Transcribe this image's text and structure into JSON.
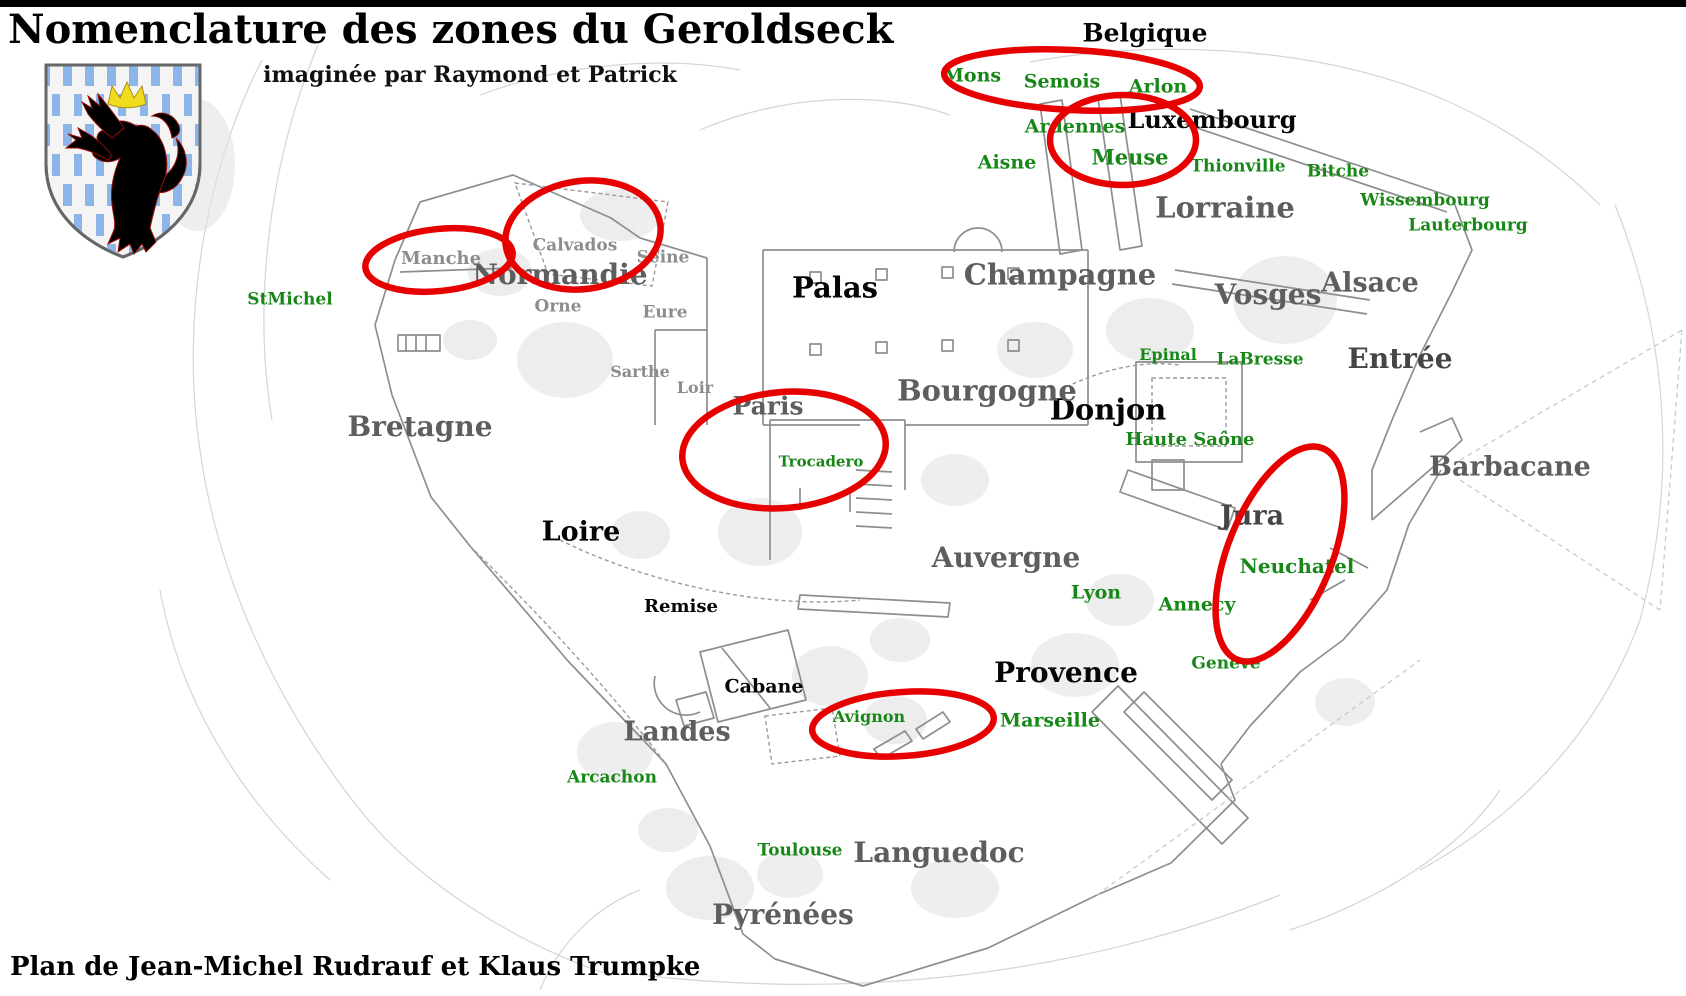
{
  "header": {
    "title": "Nomenclature des zones du Geroldseck",
    "subtitle": "imaginée par Raymond et Patrick"
  },
  "footer": {
    "credit": "Plan de Jean-Michel Rudrauf et Klaus Trumpke"
  },
  "palette": {
    "black": "#050505",
    "dark": "#454545",
    "gray": "#5e5e5e",
    "lightgray": "#8d8d8d",
    "green": "#178717",
    "annotation_red": "#e60000",
    "crest_field": "#f4f4f4",
    "crest_stripe_blue": "#8cb6ea",
    "crest_lion_red": "#e81309",
    "crest_crown_yellow": "#f2da1e"
  },
  "map": {
    "annotation_stroke_width": 6.5,
    "labels": [
      {
        "text": "Belgique",
        "x": 1145,
        "y": 33,
        "size": 25,
        "color": "black"
      },
      {
        "text": "Luxembourg",
        "x": 1212,
        "y": 120,
        "size": 24,
        "color": "black"
      },
      {
        "text": "Palas",
        "x": 835,
        "y": 288,
        "size": 29,
        "color": "black"
      },
      {
        "text": "Donjon",
        "x": 1108,
        "y": 410,
        "size": 29,
        "color": "black"
      },
      {
        "text": "Loire",
        "x": 581,
        "y": 532,
        "size": 27,
        "color": "black"
      },
      {
        "text": "Remise",
        "x": 681,
        "y": 607,
        "size": 18,
        "color": "black"
      },
      {
        "text": "Cabane",
        "x": 764,
        "y": 687,
        "size": 19,
        "color": "black"
      },
      {
        "text": "Provence",
        "x": 1066,
        "y": 673,
        "size": 28,
        "color": "black"
      },
      {
        "text": "Entrée",
        "x": 1400,
        "y": 359,
        "size": 28,
        "color": "dark"
      },
      {
        "text": "Jura",
        "x": 1252,
        "y": 516,
        "size": 27,
        "color": "dark"
      },
      {
        "text": "Normandie",
        "x": 560,
        "y": 275,
        "size": 28,
        "color": "gray"
      },
      {
        "text": "Champagne",
        "x": 1060,
        "y": 275,
        "size": 29,
        "color": "gray"
      },
      {
        "text": "Lorraine",
        "x": 1225,
        "y": 208,
        "size": 29,
        "color": "gray"
      },
      {
        "text": "Vosges",
        "x": 1268,
        "y": 295,
        "size": 28,
        "color": "gray"
      },
      {
        "text": "Alsace",
        "x": 1370,
        "y": 283,
        "size": 27,
        "color": "gray"
      },
      {
        "text": "Bourgogne",
        "x": 987,
        "y": 391,
        "size": 29,
        "color": "gray"
      },
      {
        "text": "Bretagne",
        "x": 420,
        "y": 427,
        "size": 28,
        "color": "gray"
      },
      {
        "text": "Paris",
        "x": 768,
        "y": 406,
        "size": 25,
        "color": "gray"
      },
      {
        "text": "Barbacane",
        "x": 1510,
        "y": 467,
        "size": 27,
        "color": "gray"
      },
      {
        "text": "Auvergne",
        "x": 1006,
        "y": 558,
        "size": 28,
        "color": "gray"
      },
      {
        "text": "Landes",
        "x": 677,
        "y": 732,
        "size": 27,
        "color": "gray"
      },
      {
        "text": "Languedoc",
        "x": 939,
        "y": 853,
        "size": 28,
        "color": "gray"
      },
      {
        "text": "Pyrénées",
        "x": 783,
        "y": 915,
        "size": 28,
        "color": "gray"
      },
      {
        "text": "Manche",
        "x": 441,
        "y": 259,
        "size": 18,
        "color": "lightgray"
      },
      {
        "text": "Calvados",
        "x": 575,
        "y": 246,
        "size": 17,
        "color": "lightgray"
      },
      {
        "text": "Seine",
        "x": 663,
        "y": 258,
        "size": 17,
        "color": "lightgray"
      },
      {
        "text": "Orne",
        "x": 558,
        "y": 307,
        "size": 17,
        "color": "lightgray"
      },
      {
        "text": "Eure",
        "x": 665,
        "y": 313,
        "size": 17,
        "color": "lightgray"
      },
      {
        "text": "Sarthe",
        "x": 640,
        "y": 372,
        "size": 16,
        "color": "lightgray"
      },
      {
        "text": "Loir",
        "x": 695,
        "y": 388,
        "size": 16,
        "color": "lightgray"
      },
      {
        "text": "Mons",
        "x": 972,
        "y": 76,
        "size": 19,
        "color": "green"
      },
      {
        "text": "Semois",
        "x": 1062,
        "y": 82,
        "size": 19,
        "color": "green"
      },
      {
        "text": "Arlon",
        "x": 1158,
        "y": 87,
        "size": 19,
        "color": "green"
      },
      {
        "text": "Ardennes",
        "x": 1075,
        "y": 127,
        "size": 19,
        "color": "green"
      },
      {
        "text": "Aisne",
        "x": 1007,
        "y": 163,
        "size": 19,
        "color": "green"
      },
      {
        "text": "Meuse",
        "x": 1130,
        "y": 157,
        "size": 21,
        "color": "green"
      },
      {
        "text": "Thionville",
        "x": 1238,
        "y": 167,
        "size": 17,
        "color": "green"
      },
      {
        "text": "Bitche",
        "x": 1338,
        "y": 172,
        "size": 17,
        "color": "green"
      },
      {
        "text": "Wissembourg",
        "x": 1425,
        "y": 201,
        "size": 17,
        "color": "green"
      },
      {
        "text": "Lauterbourg",
        "x": 1468,
        "y": 226,
        "size": 17,
        "color": "green"
      },
      {
        "text": "StMichel",
        "x": 290,
        "y": 300,
        "size": 17,
        "color": "green"
      },
      {
        "text": "Epinal",
        "x": 1168,
        "y": 355,
        "size": 16,
        "color": "green"
      },
      {
        "text": "LaBresse",
        "x": 1260,
        "y": 360,
        "size": 17,
        "color": "green"
      },
      {
        "text": "Haute Saône",
        "x": 1190,
        "y": 440,
        "size": 18,
        "color": "green"
      },
      {
        "text": "Trocadero",
        "x": 821,
        "y": 462,
        "size": 15,
        "color": "green"
      },
      {
        "text": "Neuchatel",
        "x": 1297,
        "y": 566,
        "size": 20,
        "color": "green"
      },
      {
        "text": "Lyon",
        "x": 1096,
        "y": 593,
        "size": 19,
        "color": "green"
      },
      {
        "text": "Annecy",
        "x": 1197,
        "y": 605,
        "size": 19,
        "color": "green"
      },
      {
        "text": "Genève",
        "x": 1226,
        "y": 664,
        "size": 17,
        "color": "green"
      },
      {
        "text": "Marseille",
        "x": 1050,
        "y": 721,
        "size": 19,
        "color": "green"
      },
      {
        "text": "Avignon",
        "x": 869,
        "y": 717,
        "size": 16,
        "color": "green"
      },
      {
        "text": "Arcachon",
        "x": 612,
        "y": 778,
        "size": 17,
        "color": "green"
      },
      {
        "text": "Toulouse",
        "x": 800,
        "y": 851,
        "size": 17,
        "color": "green"
      }
    ],
    "highlight_ellipses": [
      {
        "cx": 1072,
        "cy": 80,
        "rx": 128,
        "ry": 30,
        "rot": 3
      },
      {
        "cx": 1123,
        "cy": 140,
        "rx": 73,
        "ry": 45,
        "rot": 0
      },
      {
        "cx": 583,
        "cy": 235,
        "rx": 78,
        "ry": 54,
        "rot": -8
      },
      {
        "cx": 439,
        "cy": 260,
        "rx": 74,
        "ry": 31,
        "rot": -6
      },
      {
        "cx": 784,
        "cy": 450,
        "rx": 102,
        "ry": 58,
        "rot": -5
      },
      {
        "cx": 1280,
        "cy": 554,
        "rx": 52,
        "ry": 114,
        "rot": 22
      },
      {
        "cx": 903,
        "cy": 724,
        "rx": 91,
        "ry": 32,
        "rot": -4
      }
    ]
  }
}
